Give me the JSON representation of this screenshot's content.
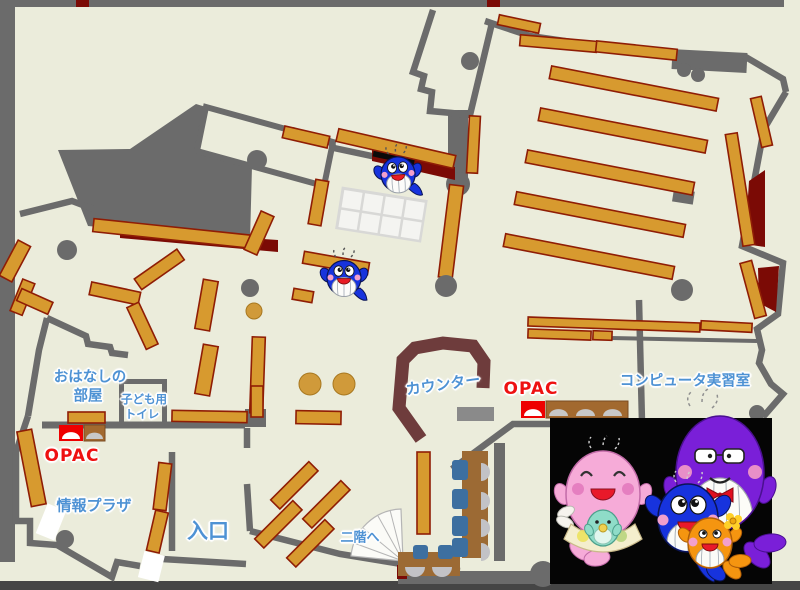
{
  "map": {
    "title_hint": "library-floor-map",
    "labels": {
      "story_room_line1": "おはなしの",
      "story_room_line2": "部屋",
      "kids_toilet_line1": "子ども用",
      "kids_toilet_line2": "トイレ",
      "opac_left": "OPAC",
      "info_plaza": "情報プラザ",
      "entrance": "入口",
      "counter": "カウンター",
      "opac_right": "OPAC",
      "computer_room": "コンピュータ実習室",
      "to_second_floor": "二階へ"
    },
    "colors": {
      "floor": "#ebecdb",
      "wall_gray": "#6b6b6b",
      "shelf_fill": "#d79a2f",
      "shelf_border": "#8f1d05",
      "dark_red": "#7b0a05",
      "counter_brown": "#6e3c3c",
      "desk_brown": "#9c6a34",
      "chair_blue": "#3d6fa0",
      "seat_gray": "#c2c2c6",
      "label_blue": "#4e92d4",
      "opac_red": "#ee1111",
      "mascot_panel_bg": "#050505"
    },
    "mascots": {
      "on_map": [
        "blue-whale-small",
        "blue-whale-small"
      ],
      "family_panel": [
        "pink-whale",
        "baby-whale",
        "blue-whale",
        "purple-whale",
        "orange-whale"
      ]
    }
  }
}
